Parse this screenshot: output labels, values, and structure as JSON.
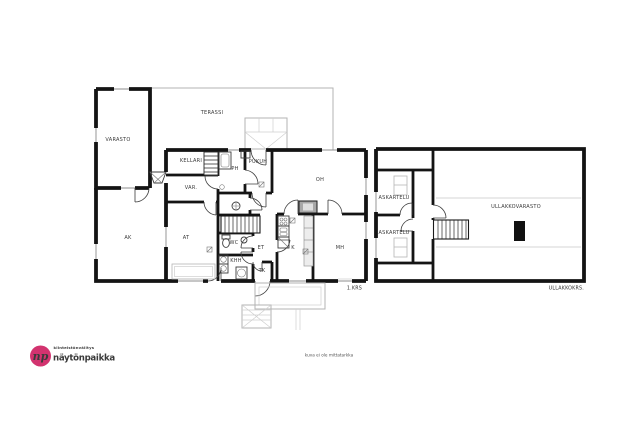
{
  "colors": {
    "wall": "#141414",
    "thin_outline": "#b3b3b3",
    "window_line": "#8c8c8c",
    "fireplace_fill": "#a8a8a8",
    "brand_pink": "#d2336f"
  },
  "floor1": {
    "caption": "1.KRS",
    "rooms": {
      "varasto": "VARASTO",
      "terassi": "TERASSI",
      "kellari": "KELLARI",
      "var": "VAR.",
      "ph": "PH",
      "pukuh": "PUKUH",
      "oh": "OH",
      "ak": "AK",
      "at": "AT",
      "wc": "WC",
      "et": "ET",
      "khh": "KHH",
      "tk": "TK",
      "k": "K",
      "mh": "MH"
    }
  },
  "attic": {
    "caption": "ULLAKKOKRS.",
    "rooms": {
      "askartelu_1": "ASKARTELU",
      "askartelu_2": "ASKARTELU",
      "ullakkovarasto": "ULLAKKOVARASTO"
    }
  },
  "footer": {
    "disclaimer": "kuva ei ole mittatarkka"
  },
  "logo": {
    "monogram": "np",
    "tagline": "kiinteistönvälitys",
    "brand": "näytönpaikka"
  }
}
